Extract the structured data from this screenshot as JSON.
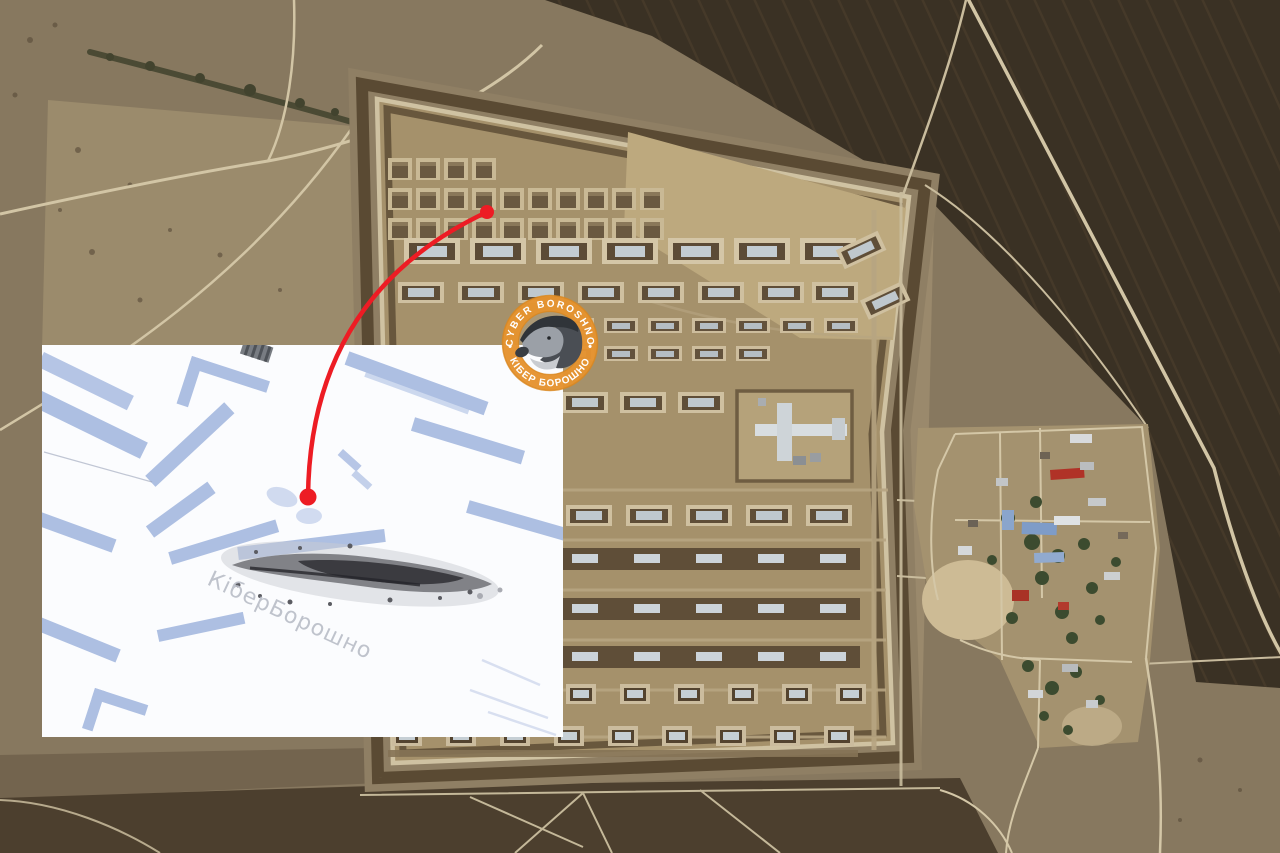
{
  "badge": {
    "top_text": "CYBER BOROSHNO",
    "bottom_text": "КІБЕР БОРОШНО",
    "separator": "•",
    "ring_color": "#e5932f",
    "text_color": "#ffffff",
    "animal": "badger-icon"
  },
  "inset": {
    "watermark": "КіберБорошно",
    "watermark_color": "#bcc0ca",
    "background": "#fbfcfe",
    "shadow_color": "#adbfe2",
    "debris_color": "#3b3b40"
  },
  "annotation": {
    "color": "#ed1c24"
  },
  "terrain": {
    "steppe": "#87785f",
    "field_light": "#9b8b6c",
    "field_dark": "#3a3124",
    "road": "#d2c5a5",
    "compound_interior": "#a5916b",
    "berm": "#5a4a33",
    "ring_road": "#cfc2a2",
    "bunker_roof": "#c9d1d7",
    "tree": "#3c4b2f"
  }
}
